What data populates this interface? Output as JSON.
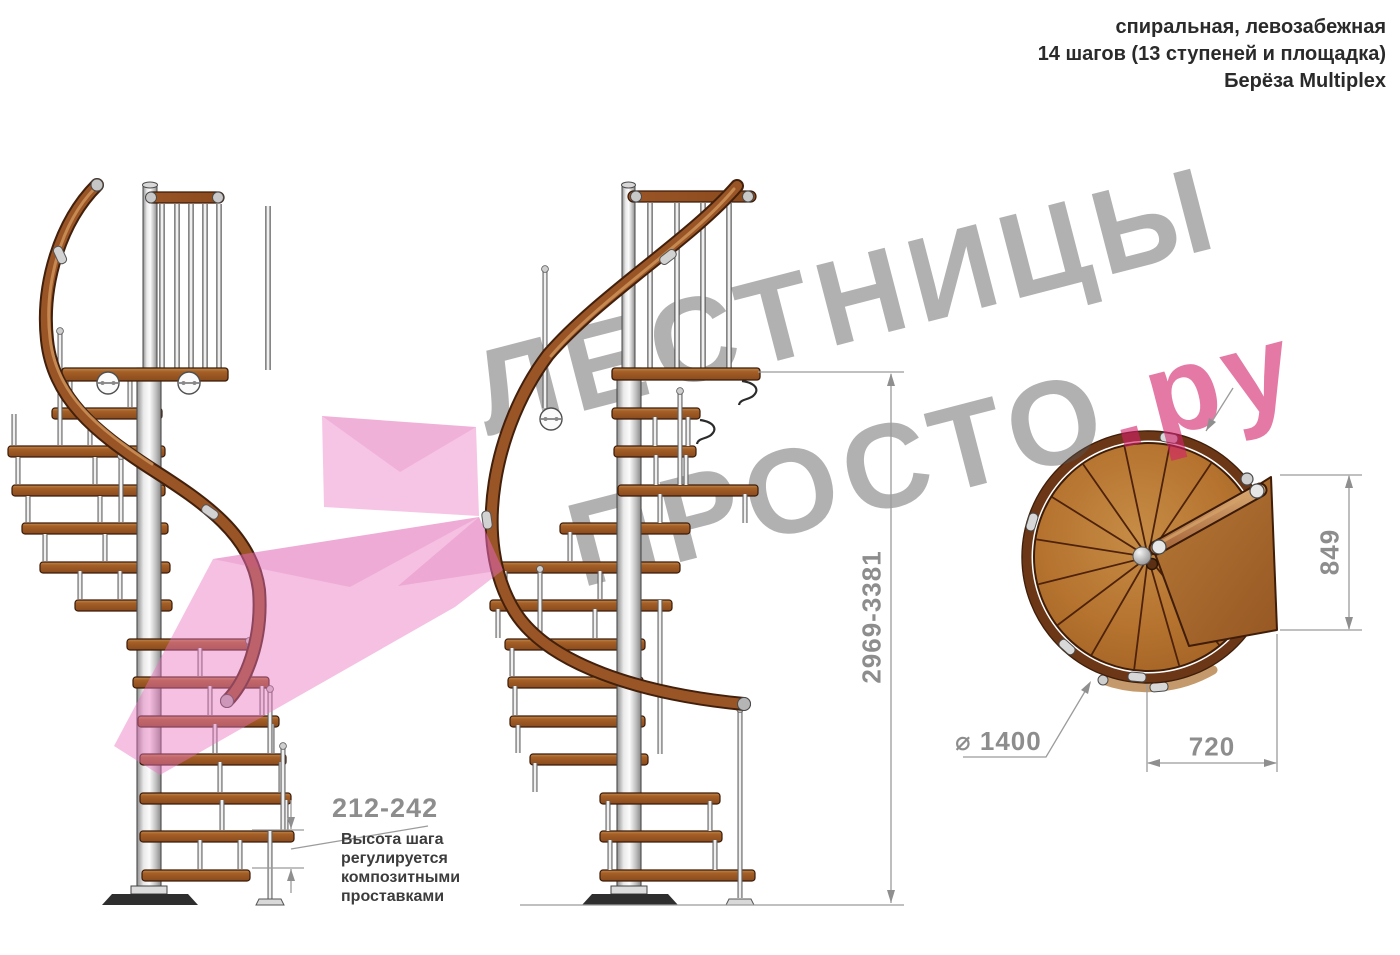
{
  "title_block": {
    "line1": "спиральная, левозабежная",
    "line2": "14 шагов (13 ступеней и площадка)",
    "line3": "Берёза Multiplex"
  },
  "watermark": {
    "line1": "ЛЕСТНИЦЫ",
    "line2_gray": "ПРОСТО",
    "line2_pink": ".ру"
  },
  "dimensions": {
    "step_height": "212-242",
    "step_height_note": {
      "l1": "Высота шага",
      "l2": "регулируется",
      "l3": "композитными",
      "l4": "проставками"
    },
    "total_height": "2969-3381",
    "landing_width": "849",
    "landing_depth": "720",
    "diameter": "⌀ 1400"
  },
  "colors": {
    "wood": "#A4662A",
    "dim_text": "#8D8D8D",
    "watermark_gray": "#ADADAD",
    "watermark_pink": "#E475A3",
    "arrow_pink": "#F3B2DB"
  }
}
